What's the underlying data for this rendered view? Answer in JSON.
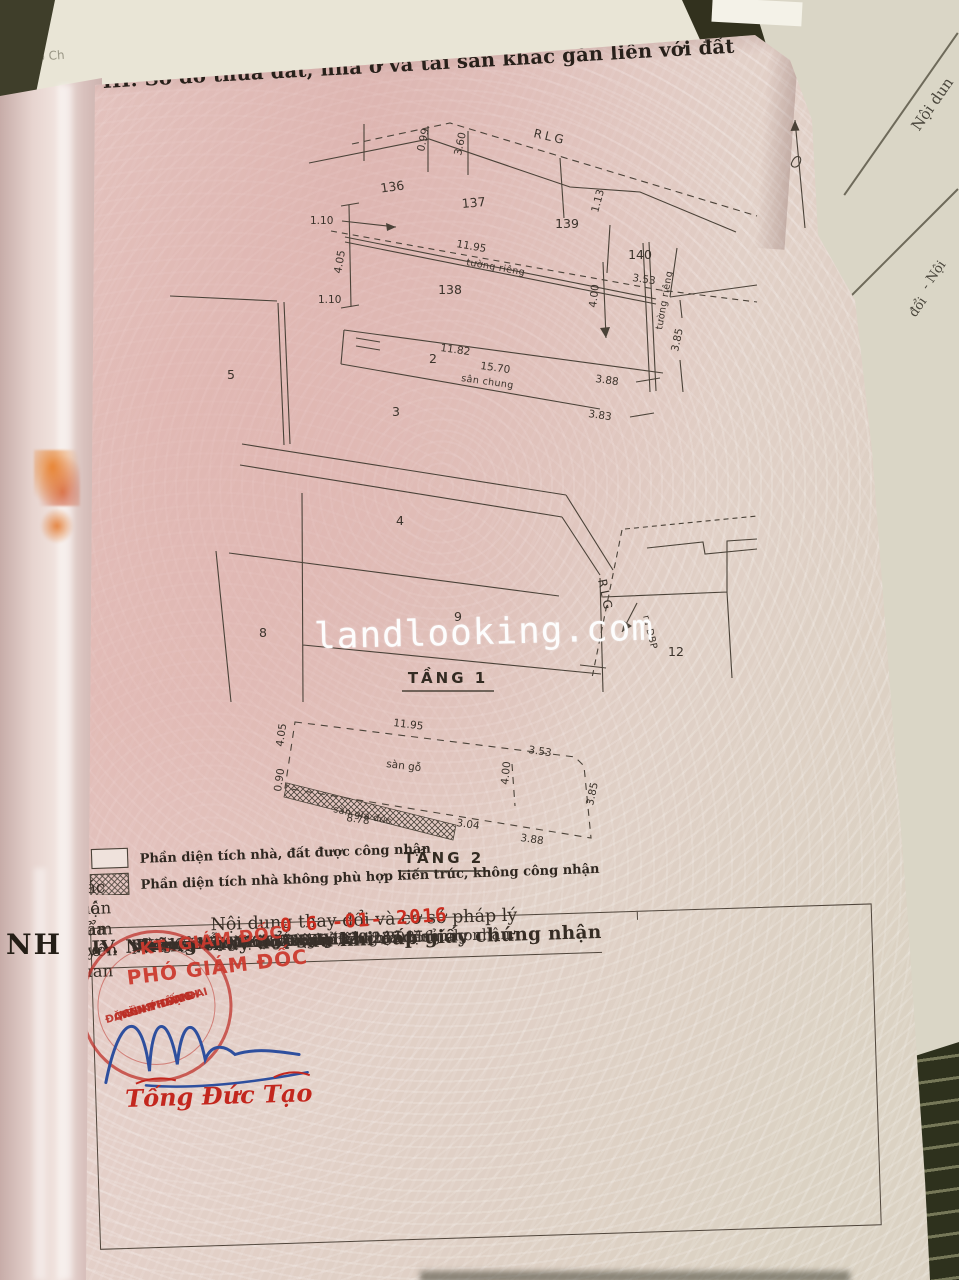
{
  "photo": {
    "watermark": "landlooking.com"
  },
  "section3": {
    "title": "III. Sơ đồ thửa đất, nhà ở và tài sản khác gắn liền với đất"
  },
  "floor1": {
    "label": "TẦNG 1",
    "rlg_top": "RLG",
    "rlg_bottom": "RLG",
    "exit": "ra ĐBP",
    "parcels": {
      "p136": "136",
      "p137": "137",
      "p138": "138",
      "p139": "139",
      "p140": "140",
      "p2": "2",
      "p3": "3",
      "p4": "4",
      "p5": "5",
      "p8": "8",
      "p9": "9",
      "p12": "12"
    },
    "dims": {
      "d099": "0.99",
      "d360": "3.60",
      "d113": "1.13",
      "d110a": "1.10",
      "d405": "4.05",
      "d110b": "1.10",
      "d1195": "11.95",
      "d353": "3.53",
      "d400": "4.00",
      "d385": "3.85",
      "d1182": "11.82",
      "d1570": "15.70",
      "d388": "3.88",
      "d383": "3.83"
    },
    "notes": {
      "wall_top": "tường riêng",
      "wall_right": "tường riêng",
      "yard": "sân chung"
    }
  },
  "floor2": {
    "label": "TẦNG 2",
    "dims": {
      "d1195": "11.95",
      "d353": "3.53",
      "d405": "4.05",
      "d090": "0.90",
      "d400": "4.00",
      "d385": "3.85",
      "d304": "3.04",
      "d388": "3.88",
      "d878": "8.78"
    },
    "notes": {
      "wood": "sàn gỗ",
      "strip": "sàn giả đúc"
    }
  },
  "legend": {
    "recognized": "Phần diện tích nhà, đất được công nhận",
    "not_recognized": "Phần diện tích nhà không phù hợp kiến trúc, không công nhận"
  },
  "section4": {
    "title": "IV. Những thay đổi sau khi cấp giấy chứng nhận",
    "col_left": "Nội dung thay đổi và cơ sở pháp lý",
    "date_stamp": "0 6 -01- 2016",
    "col_right_1": "Xác nhận của cơ quan",
    "col_right_2": "có thẩm quyền",
    "lines": [
      "Bà: NGUYỄN THỊ TÁM",
      "- Năm sinh: 1945 - CMND: 020 239 816",
      "Địa chỉ: 351 Điện Biên Phủ,",
      "phường 4, quận 3, Tp.HCM",
      "Đồng sở hữu, nhận thừa kế và nhận tặng cho",
      "theo Văn bản thoả thuận phân chia di sản",
      "thừa kế số 00017517 ngày 12/12/2015",
      "do Văn phòng Công chứng Đồng Tâm chứng nhận.",
      "(Theo hồ sơ số: 021306.TK.220)"
    ]
  },
  "approval": {
    "kt": "KT. GIÁM ĐỐC",
    "pho": "PHÓ GIÁM ĐỐC",
    "seal": [
      "CHI NHÁNH",
      "VĂN PHÒNG",
      "ĐĂNG KÝ ĐẤT ĐAI",
      "Q.BÌNH THẠNH"
    ],
    "signer": "Tống Đức Tạo"
  },
  "surroundings": {
    "left_edge": "NH",
    "top_left_1": "ký: Phó Ch",
    "top_left_2": "ng: Th",
    "right_page_1": "Nội dun",
    "right_page_2": "- Nội",
    "right_page_3": "đổi"
  }
}
